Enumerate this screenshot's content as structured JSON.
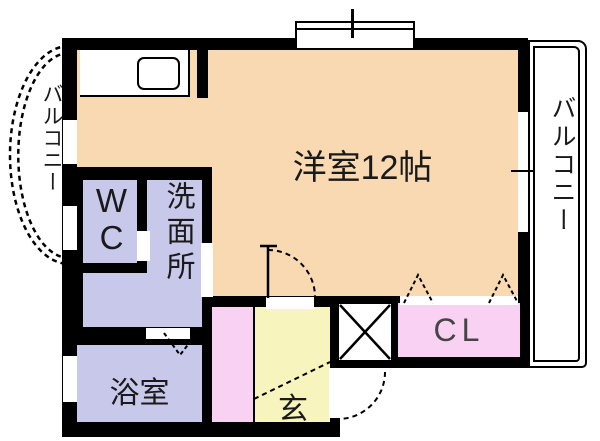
{
  "plan_title": "洋室12帖",
  "rooms": {
    "main": "洋室12帖",
    "toilet": "WC",
    "washroom": "洗面所",
    "bathroom": "浴室",
    "entrance": "玄",
    "closet": "CL",
    "balcony_left": "バルコニー",
    "balcony_right": "バルコニー"
  },
  "colors": {
    "main_room": "#f8d9b2",
    "wet_rooms": "#c8c8ea",
    "closet_fill": "#f8d1f3",
    "entrance_fill": "#f8f4bd",
    "wall": "#000000",
    "background": "#ffffff"
  }
}
